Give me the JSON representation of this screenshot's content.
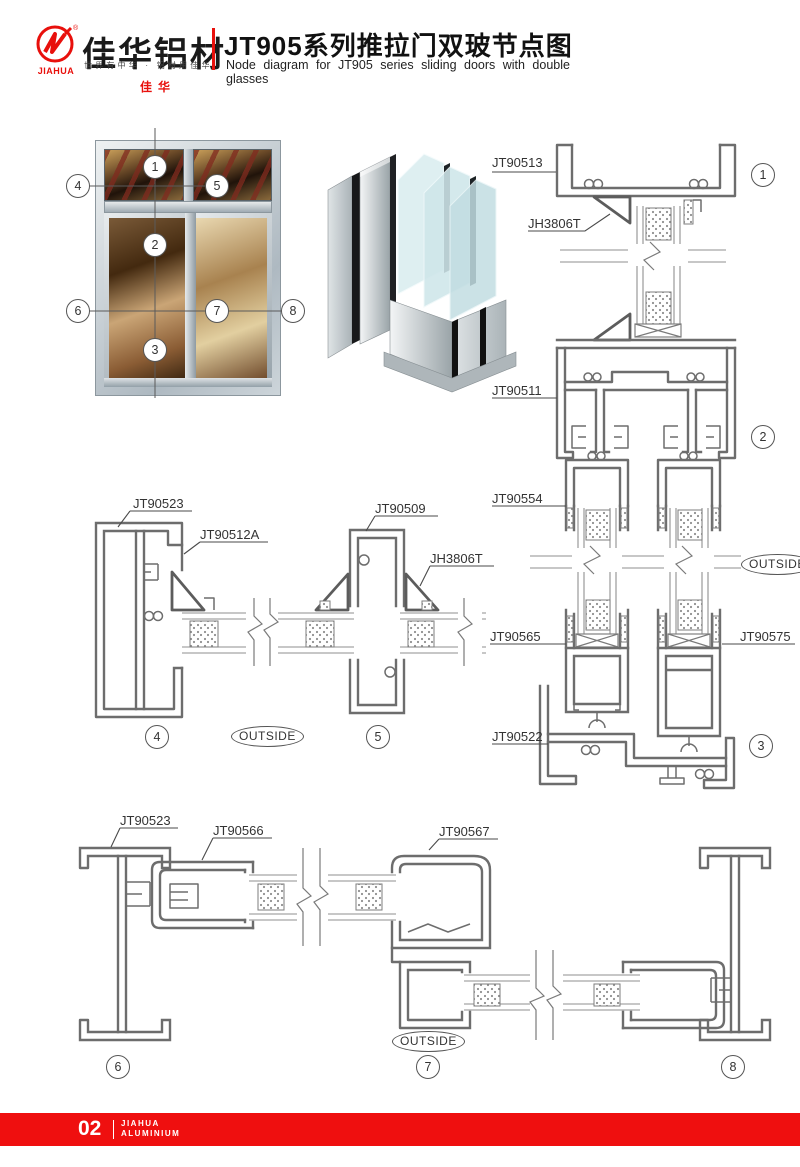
{
  "header": {
    "brand": {
      "name_en": "JIAHUA",
      "name_cn": "佳华",
      "reg": "®",
      "logo_text": "佳华铝材",
      "slogan": "世界有中华 · 铝材用佳华"
    },
    "title_cn": "JT905系列推拉门双玻节点图",
    "title_en": "Node diagram for JT905 series sliding doors with double glasses",
    "accent_color": "#e8100c"
  },
  "elevation": {
    "markers": [
      "1",
      "2",
      "3",
      "4",
      "5",
      "6",
      "7",
      "8"
    ]
  },
  "sections": {
    "right": {
      "labels": [
        "JT90513",
        "JH3806T",
        "JT90511",
        "JT90554",
        "JT90565",
        "JT90575",
        "JT90522"
      ],
      "details": [
        "1",
        "2",
        "3"
      ],
      "outside": "OUTSIDE"
    },
    "middle": {
      "labels": [
        "JT90523",
        "JT90512A",
        "JT90509",
        "JH3806T"
      ],
      "details": [
        "4",
        "5"
      ],
      "outside": "OUTSIDE"
    },
    "bottom": {
      "labels": [
        "JT90523",
        "JT90566",
        "JT90567"
      ],
      "details": [
        "6",
        "7",
        "8"
      ],
      "outside": "OUTSIDE"
    }
  },
  "footer": {
    "page_number": "02",
    "brand_line1": "JIAHUA",
    "brand_line2": "ALUMINIUM"
  }
}
